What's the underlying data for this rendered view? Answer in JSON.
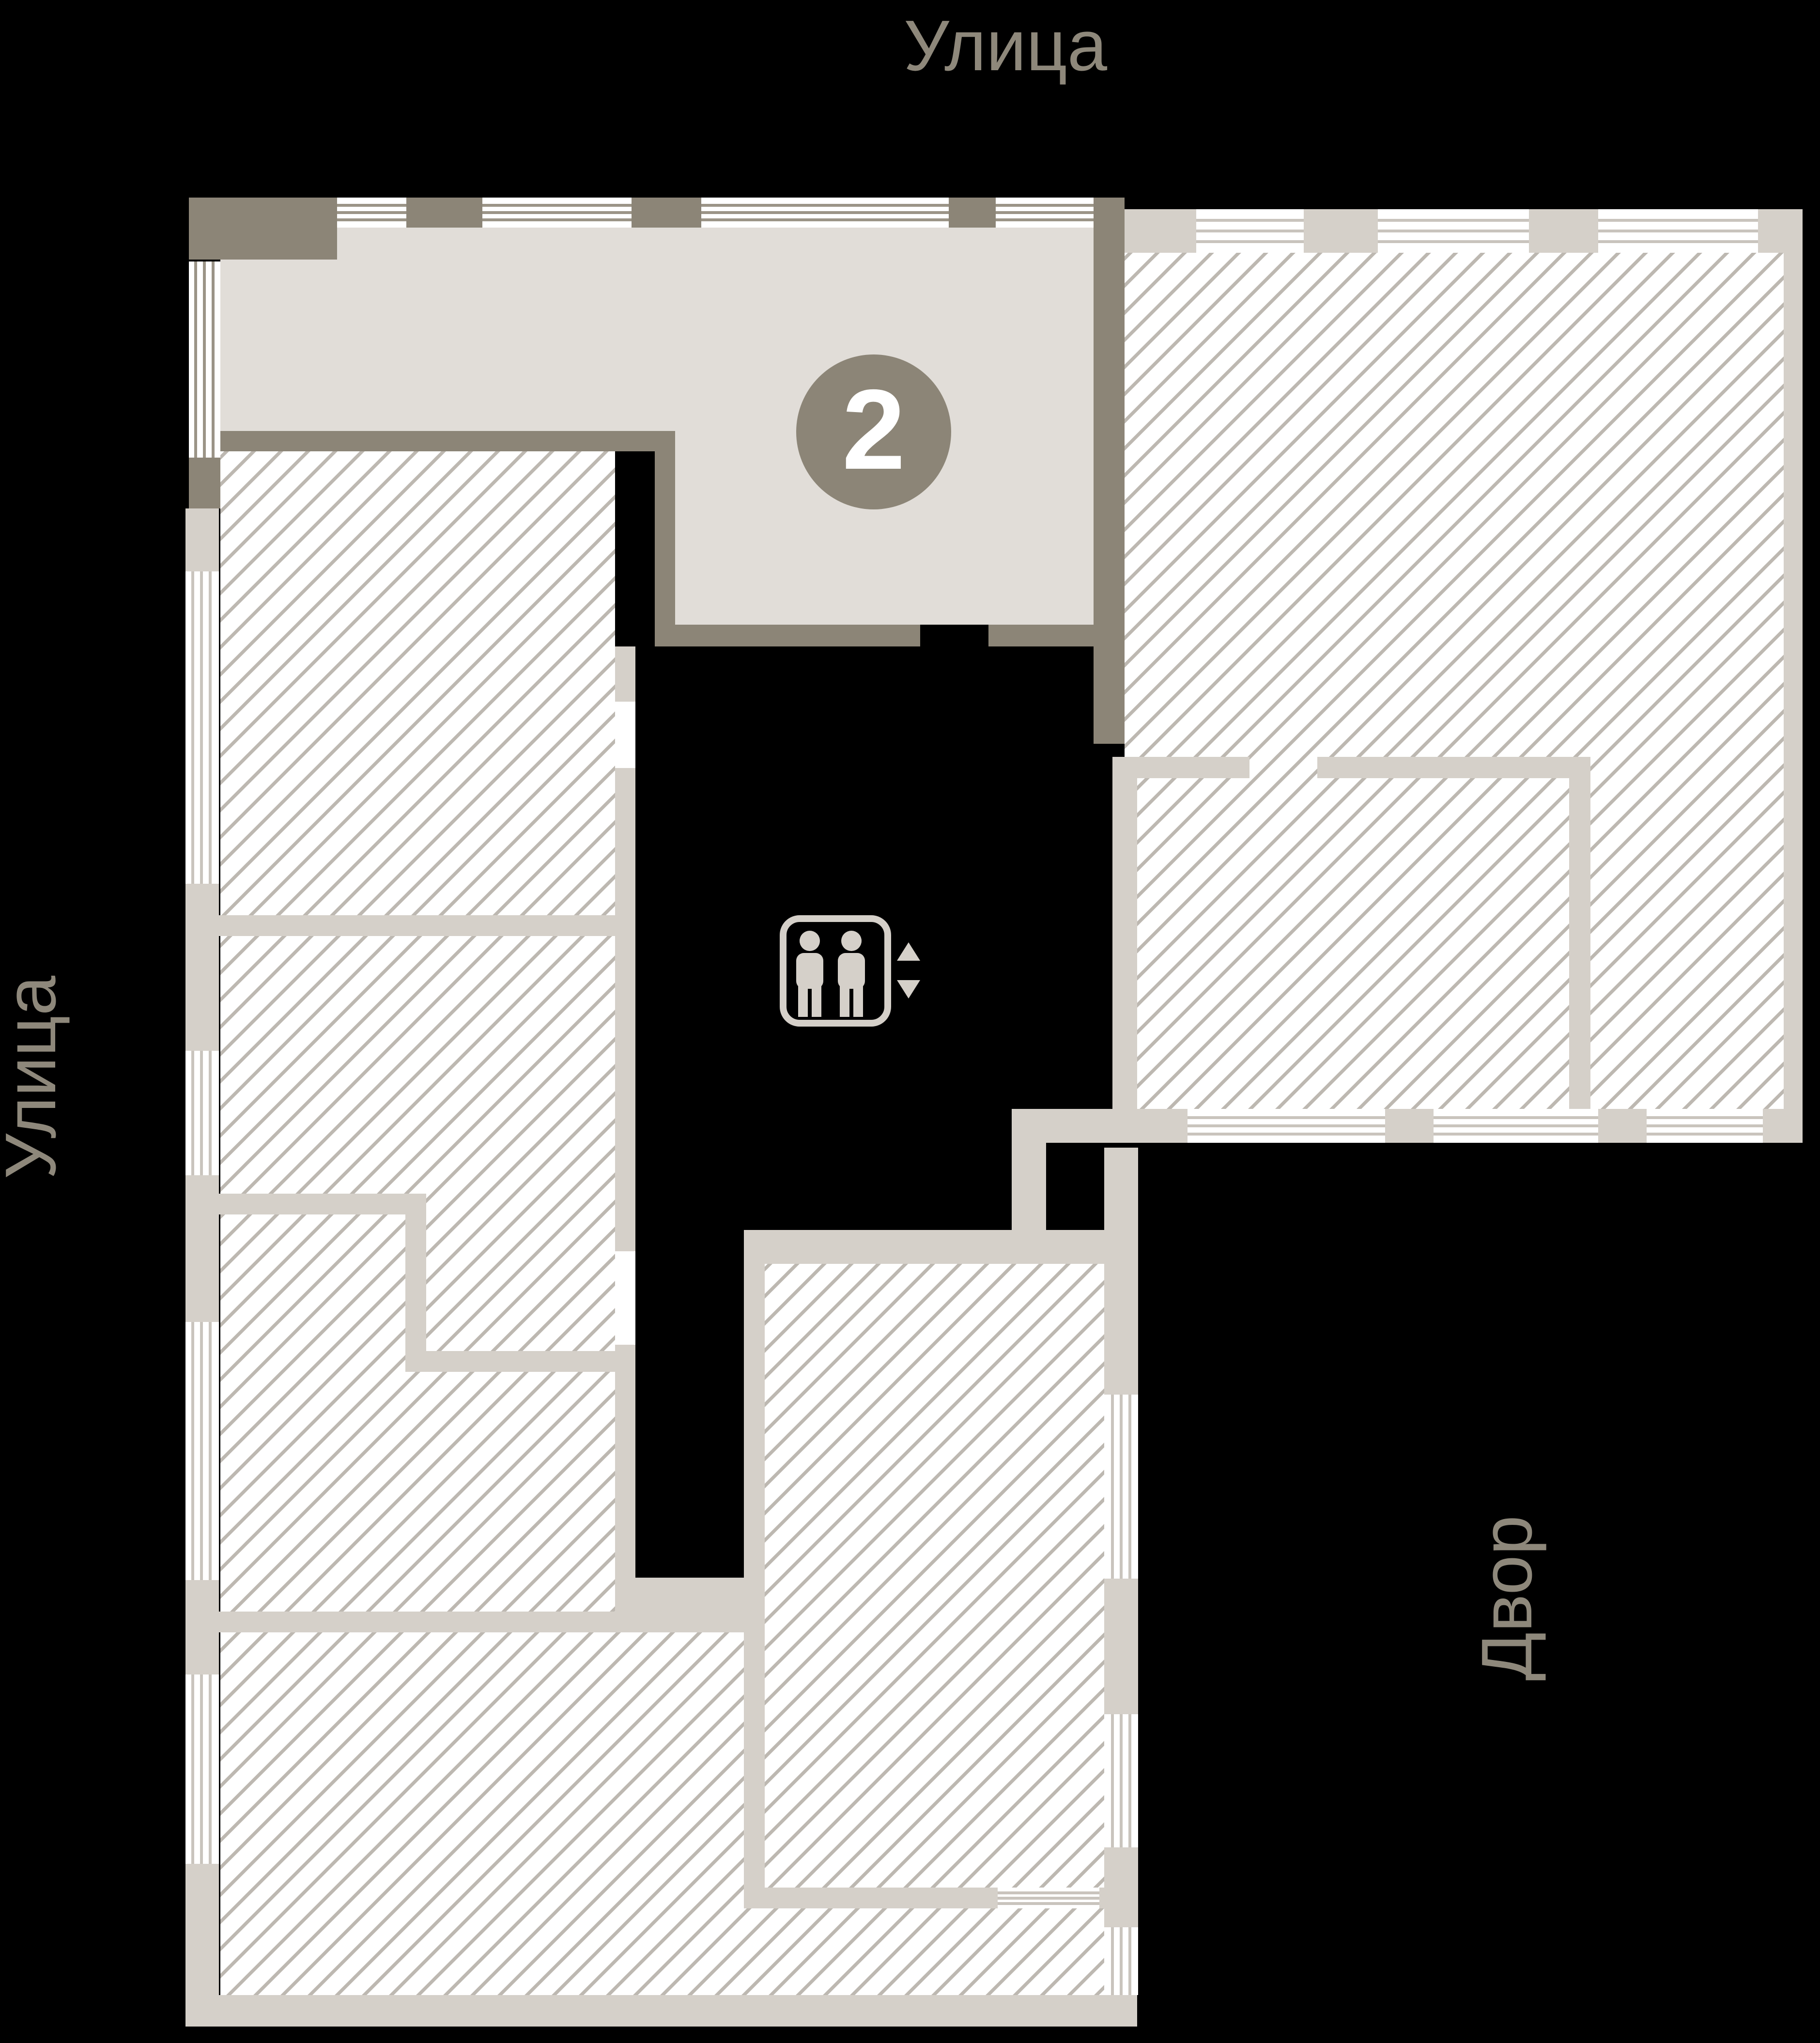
{
  "labels": {
    "street_top": "Улица",
    "street_left": "Улица",
    "courtyard_right": "Двор"
  },
  "unit": {
    "number": "2"
  },
  "icons": {
    "elevator": "elevator-people-icon",
    "up": "triangle-up-icon",
    "down": "triangle-down-icon"
  },
  "colors": {
    "background": "#000000",
    "dark_wall": "#8c8577",
    "light_wall": "#d5d0c9",
    "apartment_fill": "#e1ddd8",
    "hatch_line": "#bdb8b1",
    "window_line_light": "#c9c4bd",
    "window_line_dark": "#9b9487",
    "label_text": "#8e887b",
    "badge_bg": "#8c8577",
    "badge_number": "#ffffff"
  }
}
